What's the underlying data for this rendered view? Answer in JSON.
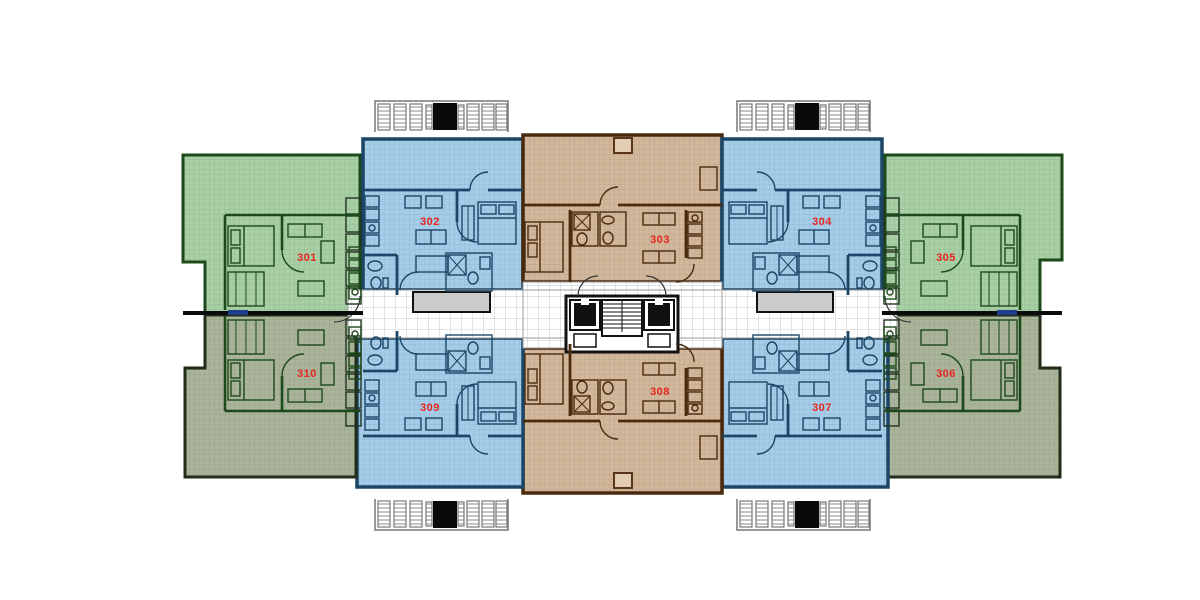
{
  "plan": {
    "unit_label_color": "#e8251f",
    "units": [
      {
        "number": "301",
        "zone": "green",
        "row": "top",
        "side": "left",
        "color": "#a8cfa5"
      },
      {
        "number": "302",
        "zone": "blue",
        "row": "top",
        "side": "left",
        "color": "#a5cce8"
      },
      {
        "number": "303",
        "zone": "tan",
        "row": "top",
        "side": "center",
        "color": "#d3b79b"
      },
      {
        "number": "304",
        "zone": "blue",
        "row": "top",
        "side": "right",
        "color": "#a5cce8"
      },
      {
        "number": "305",
        "zone": "green",
        "row": "top",
        "side": "right",
        "color": "#a8cfa5"
      },
      {
        "number": "306",
        "zone": "olive",
        "row": "bottom",
        "side": "right",
        "color": "#a9b49a"
      },
      {
        "number": "307",
        "zone": "blue",
        "row": "bottom",
        "side": "right",
        "color": "#a5cce8"
      },
      {
        "number": "308",
        "zone": "tan",
        "row": "bottom",
        "side": "center",
        "color": "#d3b79b"
      },
      {
        "number": "309",
        "zone": "blue",
        "row": "bottom",
        "side": "left",
        "color": "#a5cce8"
      },
      {
        "number": "310",
        "zone": "olive",
        "row": "bottom",
        "side": "left",
        "color": "#a9b49a"
      }
    ],
    "zone_colors": {
      "green": "#a8cfa5",
      "olive": "#a9b49a",
      "blue": "#a5cce8",
      "tan": "#d3b79b"
    },
    "wall_colors": {
      "green": "#1d4a1a",
      "olive": "#202d18",
      "blue": "#1c4668",
      "tan": "#4a2a0e",
      "core": "#111111",
      "party_wall": "#0b0b0b"
    },
    "corridor": {
      "fill": "#ffffff",
      "grid_line": "#c8c8c8",
      "entry_mat_fill": "#cbcbcb",
      "entry_mat_border": "#111111"
    },
    "accents": {
      "window_marker_blue": "#1d3f8c",
      "louver_outline": "#777777",
      "vent_black": "#0a0a0a",
      "roof_hatch_fill": "#e3cdb2"
    },
    "icons": [
      "elevator-icon",
      "staircase-icon",
      "louver-vent-icon",
      "entry-mat",
      "roof-hatch",
      "bed-icon",
      "sofa-icon",
      "shower-icon",
      "toilet-icon",
      "kitchen-icon",
      "door-arc"
    ]
  }
}
